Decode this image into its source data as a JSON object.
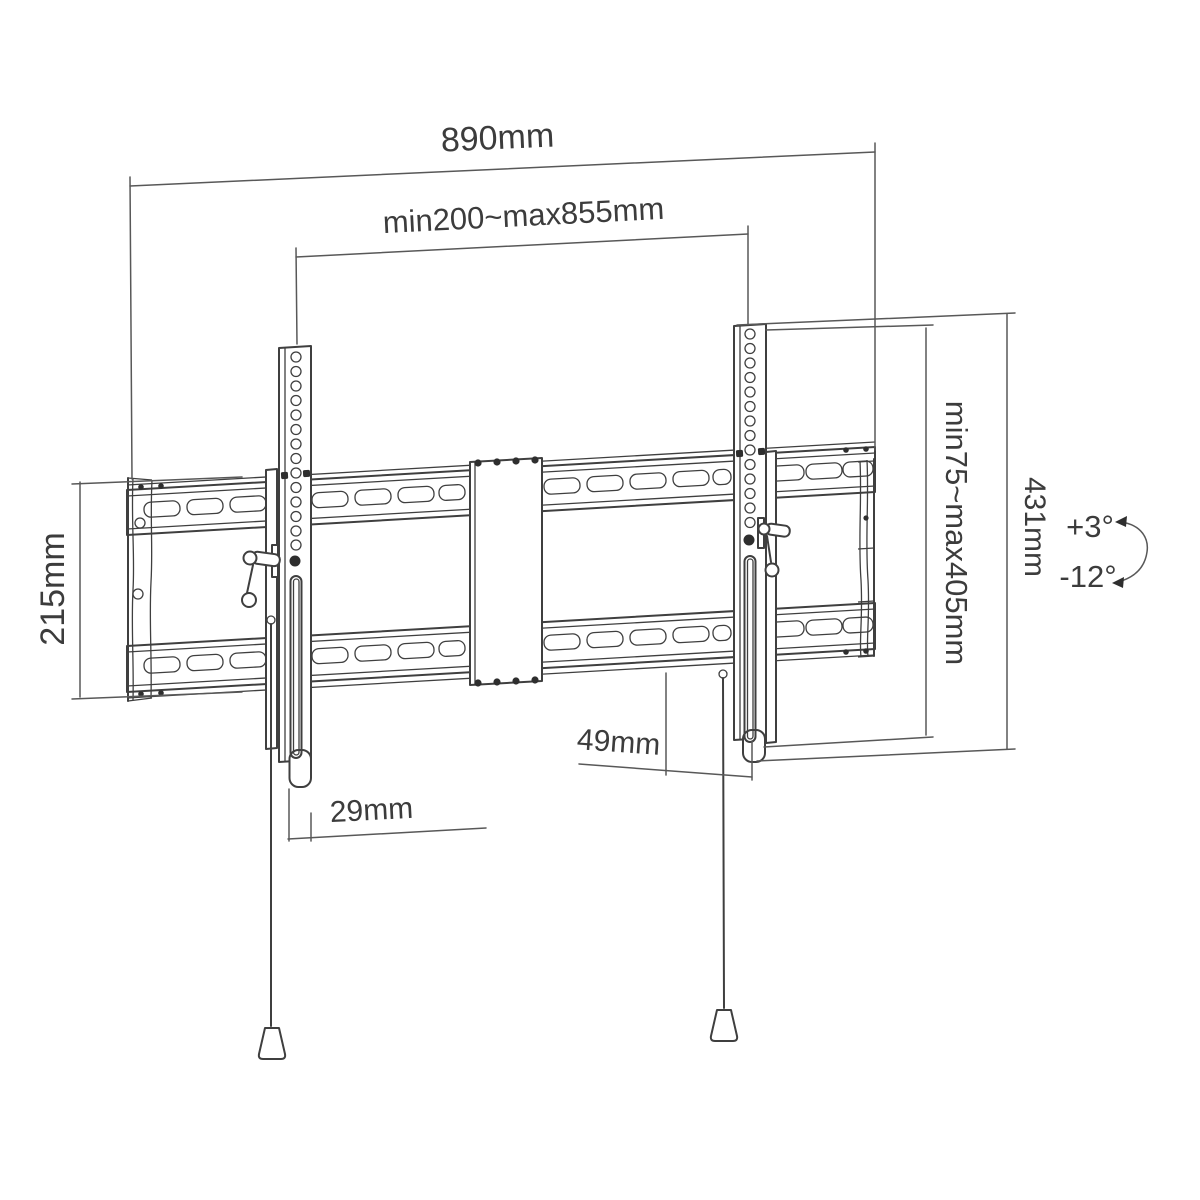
{
  "colors": {
    "background": "#ffffff",
    "drawing_line": "#3f3f3f",
    "dimension_line": "#585858",
    "text": "#3c3c3c"
  },
  "dims": {
    "overall_width": "890mm",
    "rail_span": "min200~max855mm",
    "plate_height": "215mm",
    "vesa_range": "min75~max405mm",
    "total_height": "431mm",
    "depth_49": "49mm",
    "depth_29": "29mm",
    "tilt_up": "+3°",
    "tilt_down": "-12°"
  }
}
